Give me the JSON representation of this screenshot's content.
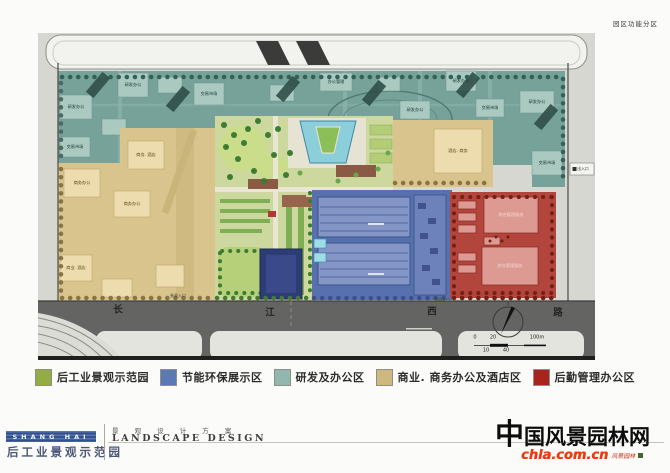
{
  "page": {
    "top_right_label": "园区功能分区",
    "watermark": {
      "title": "中国风景园林网",
      "url": "chla.com.cn",
      "seal": "风景园林"
    },
    "footer": {
      "logo_text": "SHANG HAI",
      "project_title": "后工业景观示范园",
      "subtitle_cn": "景 观 设 计 方 案",
      "subtitle_en": "LANDSCAPE DESIGN"
    }
  },
  "legend": {
    "items": [
      {
        "label": "后工业景观示范园",
        "color": "#94ad42"
      },
      {
        "label": "节能环保展示区",
        "color": "#5b79b4"
      },
      {
        "label": "研发及办公区",
        "color": "#92b7ae"
      },
      {
        "label": "商业. 商务办公及酒店区",
        "color": "#cdb97e"
      },
      {
        "label": "后勤管理办公区",
        "color": "#a9241c"
      }
    ]
  },
  "plan": {
    "zone_colors": {
      "park_green": "#ccd89e",
      "energy_blue": "#5771ae",
      "rd_teal": "#76a29a",
      "commercial_tan": "#d8c48c",
      "logistics_red": "#b2453c"
    },
    "labels": [
      {
        "cls": "zt",
        "x": 95,
        "y": 52,
        "text": "研发办公"
      },
      {
        "cls": "zt",
        "x": 38,
        "y": 74,
        "text": "研发办公"
      },
      {
        "cls": "zt",
        "x": 37,
        "y": 114,
        "text": "交易市场"
      },
      {
        "cls": "zt",
        "x": 171,
        "y": 61,
        "text": "交易市场"
      },
      {
        "cls": "zt",
        "x": 298,
        "y": 49,
        "text": "办公管理"
      },
      {
        "cls": "zt",
        "x": 377,
        "y": 77,
        "text": "研发办公"
      },
      {
        "cls": "zt",
        "x": 423,
        "y": 48,
        "text": "研发办公"
      },
      {
        "cls": "zt",
        "x": 499,
        "y": 69,
        "text": "研发办公"
      },
      {
        "cls": "zt",
        "x": 452,
        "y": 75,
        "text": "交易市场"
      },
      {
        "cls": "zt",
        "x": 509,
        "y": 130,
        "text": "交易市场"
      },
      {
        "cls": "zb",
        "x": 44,
        "y": 150,
        "text": "商务办公"
      },
      {
        "cls": "zb",
        "x": 94,
        "y": 171,
        "text": "商务办公"
      },
      {
        "cls": "zb",
        "x": 38,
        "y": 235,
        "text": "商业. 酒店"
      },
      {
        "cls": "zb",
        "x": 108,
        "y": 122,
        "text": "商务. 酒店"
      },
      {
        "cls": "zb",
        "x": 420,
        "y": 118,
        "text": "酒店. 商务"
      },
      {
        "cls": "zr",
        "x": 473,
        "y": 182,
        "text": "综合管理服务"
      },
      {
        "cls": "zr",
        "x": 472,
        "y": 233,
        "text": "综合管理服务"
      },
      {
        "cls": "rd",
        "x": 80,
        "y": 277,
        "text": "长"
      },
      {
        "cls": "rd",
        "x": 232,
        "y": 280,
        "text": "江"
      },
      {
        "cls": "rd",
        "x": 394,
        "y": 279,
        "text": "西"
      },
      {
        "cls": "rd",
        "x": 520,
        "y": 280,
        "text": "路"
      },
      {
        "cls": "en",
        "x": 140,
        "y": 263,
        "text": "参观入口"
      },
      {
        "cls": "en",
        "x": 404,
        "y": 267,
        "text": "专用入口"
      },
      {
        "cls": "bx",
        "x": 545,
        "y": 136,
        "text": "出入口"
      },
      {
        "cls": "sc",
        "x": 437,
        "y": 305,
        "text": "0"
      },
      {
        "cls": "sc",
        "x": 455,
        "y": 305,
        "text": "20"
      },
      {
        "cls": "sc",
        "x": 499,
        "y": 305,
        "text": "100m"
      },
      {
        "cls": "sc",
        "x": 448,
        "y": 318,
        "text": "10"
      },
      {
        "cls": "sc",
        "x": 468,
        "y": 318,
        "text": "40"
      }
    ]
  }
}
